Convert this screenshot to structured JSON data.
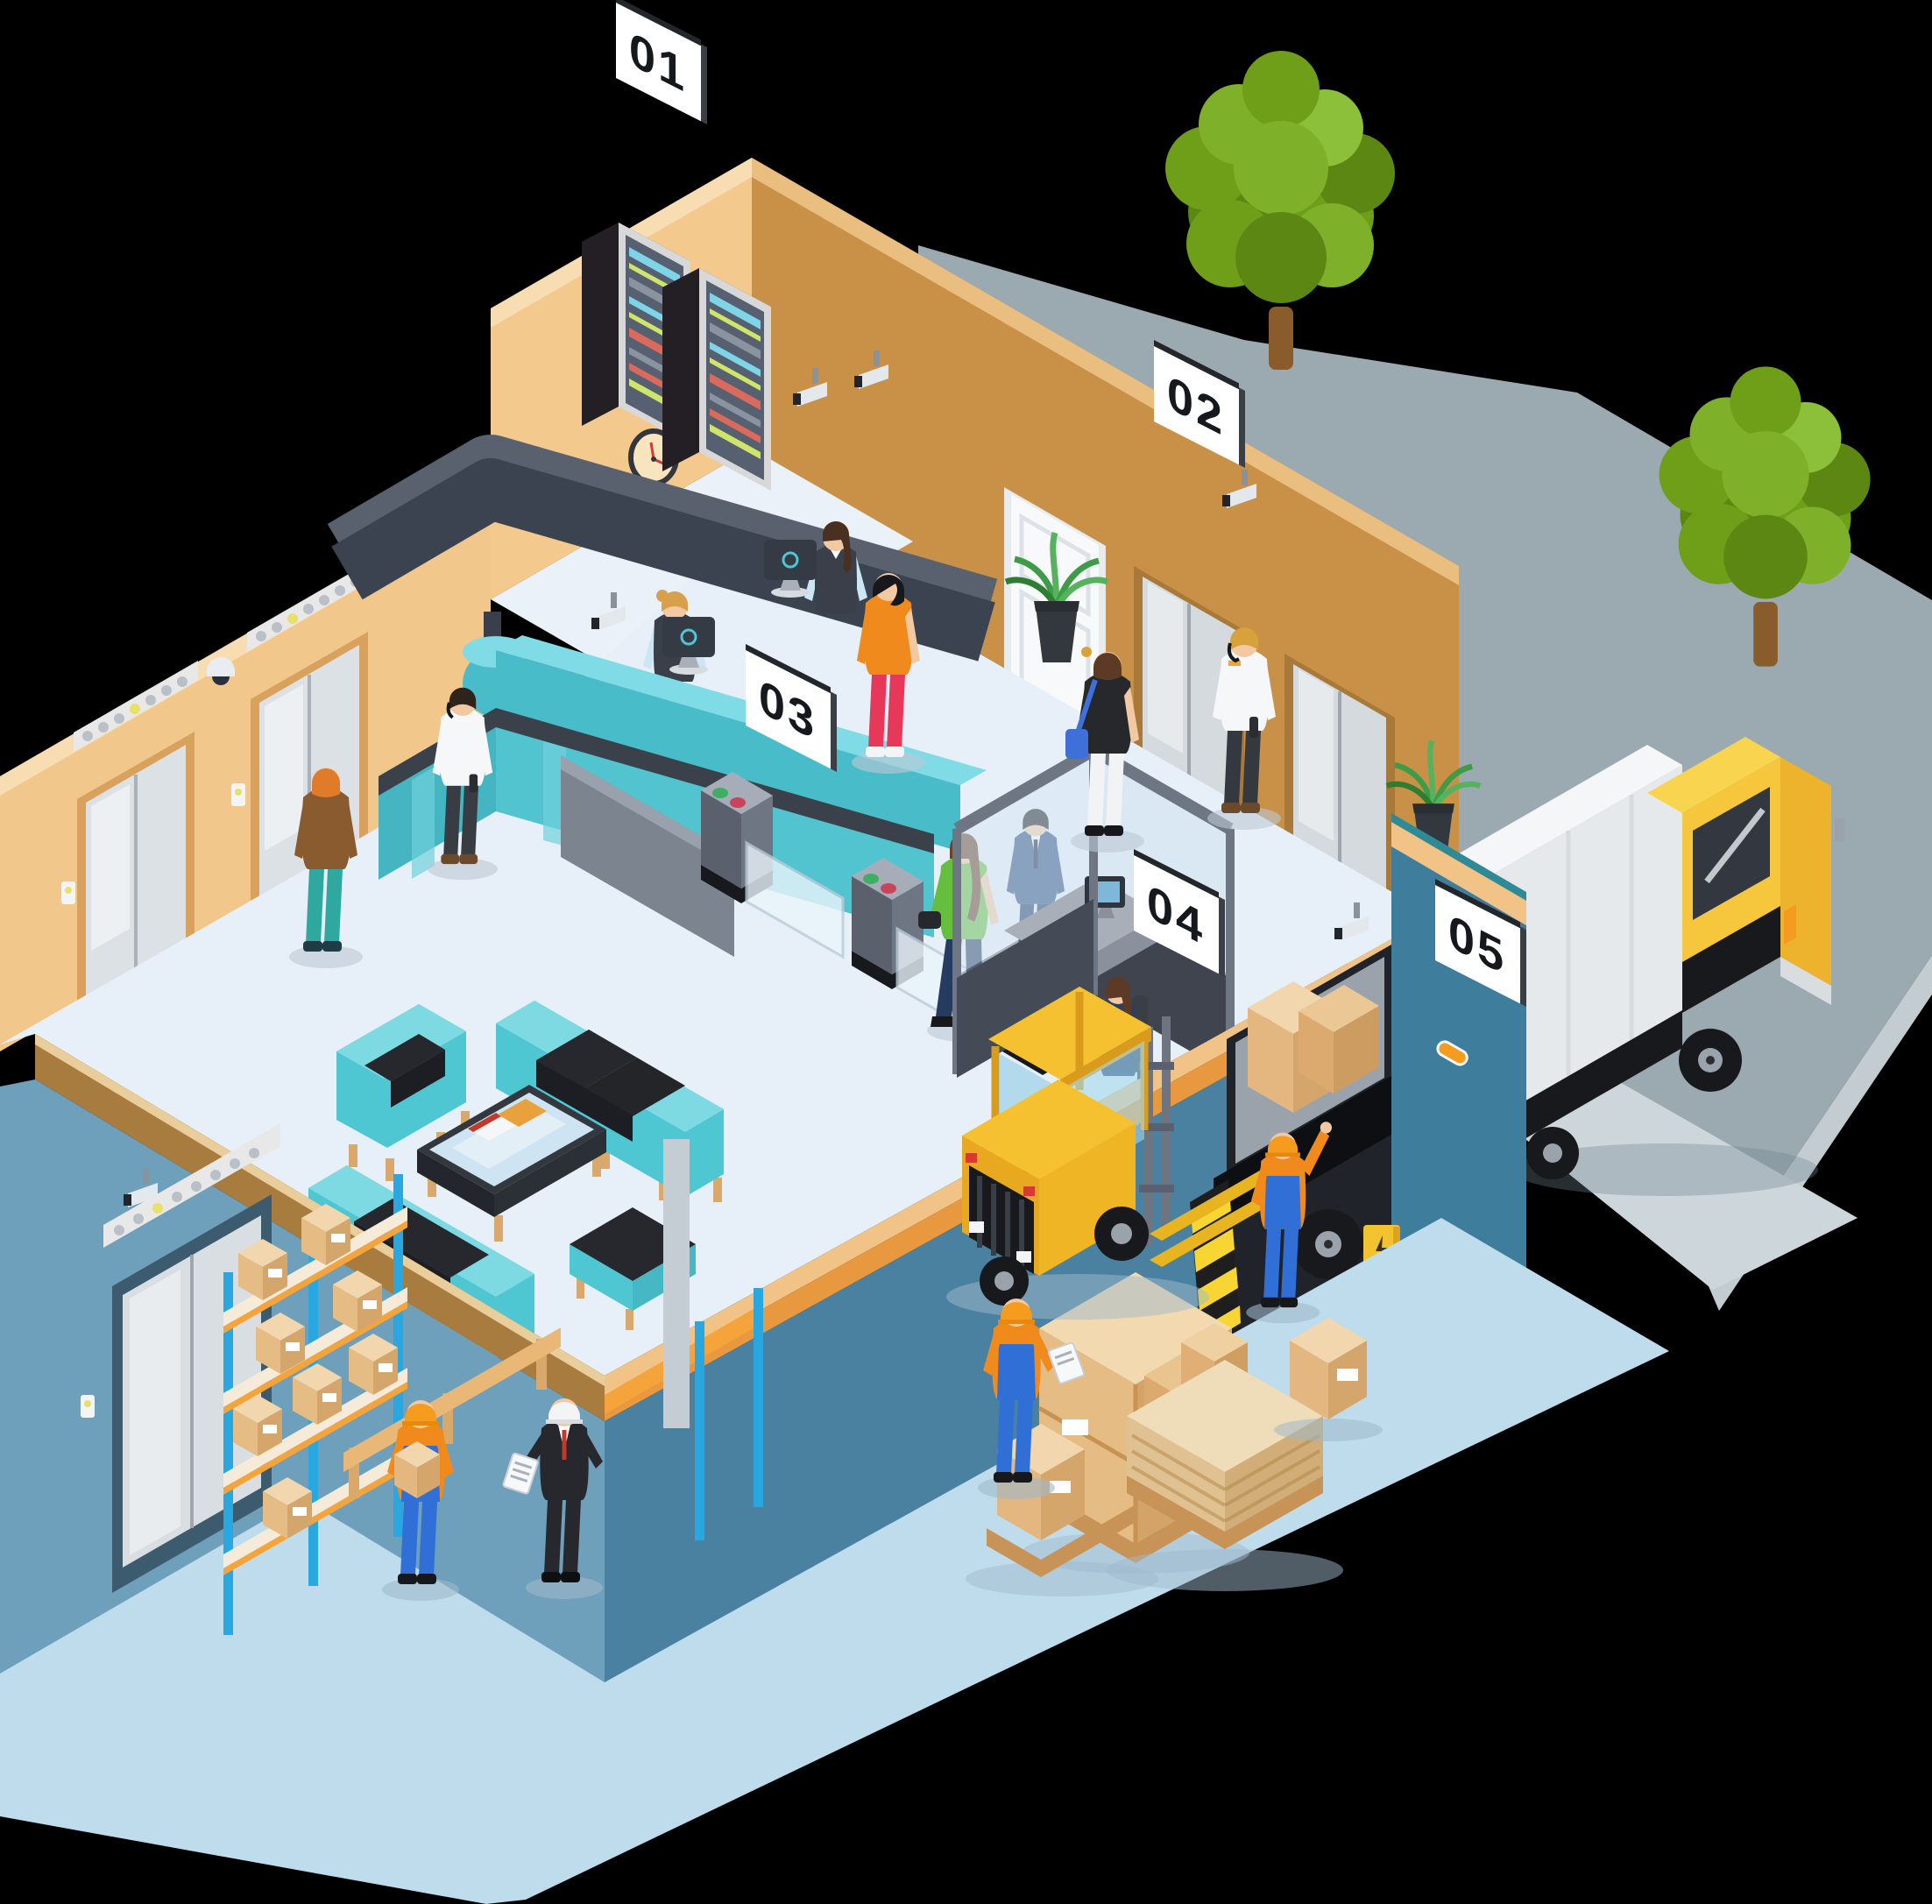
{
  "scene": {
    "title": "Isometric office and warehouse security cutaway",
    "background": "#000000"
  },
  "signs": [
    {
      "id": "sign-01",
      "label": "01",
      "area": "server-room"
    },
    {
      "id": "sign-02",
      "label": "02",
      "area": "elevator-lobby"
    },
    {
      "id": "sign-03",
      "label": "03",
      "area": "access-turnstiles"
    },
    {
      "id": "sign-04",
      "label": "04",
      "area": "security-desk"
    },
    {
      "id": "sign-05",
      "label": "05",
      "area": "loading-dock"
    }
  ],
  "palette": {
    "background": "#000000",
    "wall_tan_light": "#F2C78C",
    "wall_tan_dark": "#C99147",
    "wall_cap": "#F8DCB2",
    "slab_edge_brown": "#A87C3E",
    "slab_edge_tan": "#F2C387",
    "slab_edge_orange": "#E8993F",
    "wall_blue_light": "#6E9FBB",
    "wall_blue_dark": "#4A81A0",
    "wall_blue_exterior": "#3E7D9B",
    "floor_upper": "#E7EFF8",
    "floor_lower": "#BFDCEC",
    "pavement_gray": "#9BA9B0",
    "sofa_teal": "#4FC7D2",
    "desk_teal": "#49BCC9",
    "cushion_dark": "#26282E",
    "rack_post_blue": "#29A7E0",
    "shelf_orange": "#F5A43C",
    "box_tan": "#E6BC85",
    "forklift_yellow": "#F5C131",
    "truck_yellow": "#F6C63D",
    "hazard_yellow": "#F7D633",
    "tree_green": "#7FB02A",
    "sign_bg": "#FFFFFF",
    "sign_text": "#15181D"
  }
}
